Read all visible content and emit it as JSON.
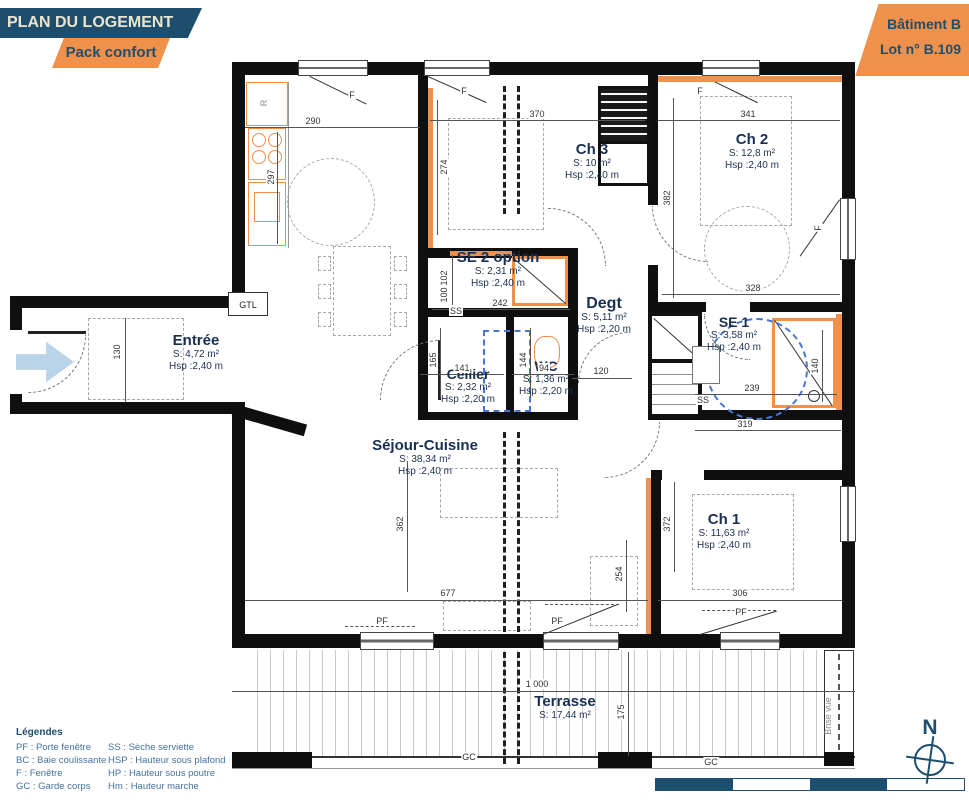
{
  "header": {
    "title": "PLAN DU LOGEMENT",
    "pack": "Pack confort",
    "batiment": "Bâtiment B",
    "lot": "Lot n°  B.109"
  },
  "rooms": {
    "entree": {
      "name": "Entrée",
      "area": "S: 4,72 m²",
      "height": "Hsp :2,40 m"
    },
    "ch3": {
      "name": "Ch 3",
      "area": "S: 10 m²",
      "height": "Hsp :2,40 m"
    },
    "ch2": {
      "name": "Ch 2",
      "area": "S: 12,8 m²",
      "height": "Hsp :2,40 m"
    },
    "se2": {
      "name": "SE 2 option",
      "area": "S: 2,31 m²",
      "height": "Hsp :2,40 m"
    },
    "degt": {
      "name": "Degt",
      "area": "S: 5,11 m²",
      "height": "Hsp :2,20 m"
    },
    "se1": {
      "name": "SE 1",
      "area": "S: 3,58 m²",
      "height": "Hsp :2,40 m"
    },
    "cellier": {
      "name": "Cellier",
      "area": "S: 2,32 m²",
      "height": "Hsp :2,20 m"
    },
    "wc": {
      "name": "WC",
      "area": "S: 1,36 m²",
      "height": "Hsp :2,20 m"
    },
    "sejour": {
      "name": "Séjour-Cuisine",
      "area": "S: 38,34 m²",
      "height": "Hsp :2,40 m"
    },
    "ch1": {
      "name": "Ch 1",
      "area": "S: 11,63 m²",
      "height": "Hsp :2,40 m"
    },
    "terrasse": {
      "name": "Terrasse",
      "area": "S: 17,44 m²"
    }
  },
  "dims": {
    "d290": "290",
    "d370": "370",
    "d341": "341",
    "d297": "297",
    "d274": "274",
    "d382": "382",
    "d328": "328",
    "d130": "130",
    "d102": "102",
    "d100": "100",
    "d242": "242",
    "d141": "141",
    "d94": "94",
    "d120": "120",
    "d165": "165",
    "d144": "144",
    "d239": "239",
    "d140": "140",
    "d319": "319",
    "d362": "362",
    "d372": "372",
    "d254": "254",
    "d677": "677",
    "d306": "306",
    "d1000": "1 000",
    "d175": "175"
  },
  "labels": {
    "r": "R",
    "gtl": "GTL",
    "f": "F",
    "pf": "PF",
    "gc": "GC",
    "ss": "SS",
    "brise_vue": "Brise vue",
    "north": "N"
  },
  "legend": {
    "title": "Légendes",
    "col1": [
      "PF : Porte fenêtre",
      "BC : Baie coulissante",
      "F : Fenêtre",
      "GC : Garde corps"
    ],
    "col2": [
      "SS : Sèche serviette",
      "HSP : Hauteur sous plafond",
      "HP : Hauteur sous poutre",
      "Hm : Hauteur marche"
    ]
  },
  "colors": {
    "navy": "#1d4e6e",
    "orange": "#f0914b",
    "cream": "#ece4cc",
    "legend_blue": "#44729f"
  }
}
